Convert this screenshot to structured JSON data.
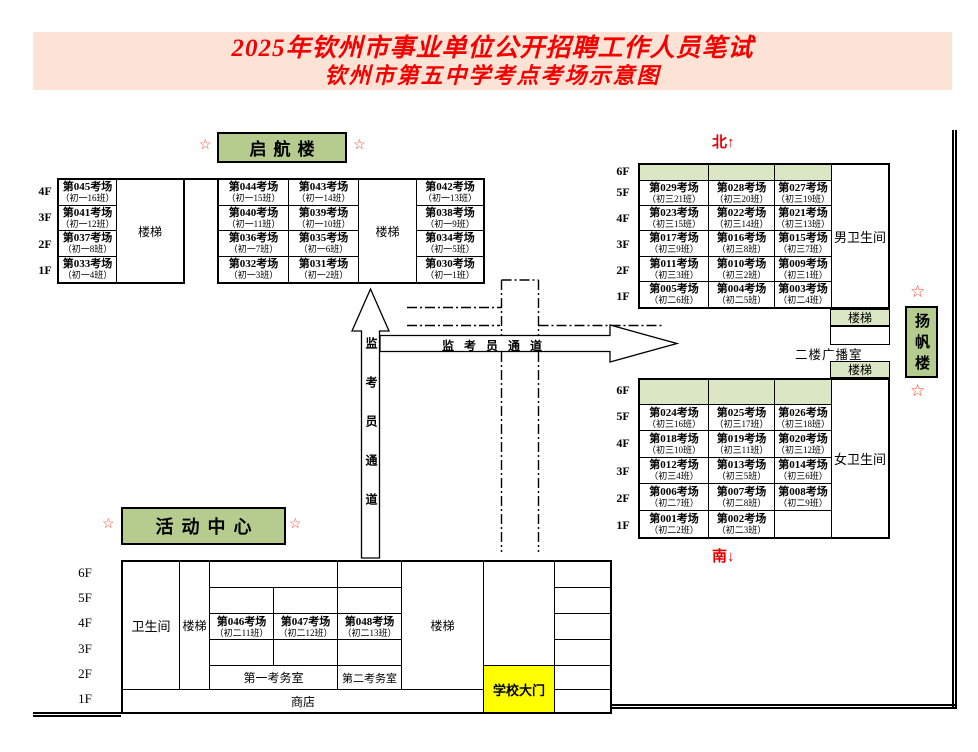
{
  "title": {
    "line1": "2025年钦州市事业单位公开招聘工作人员笔试",
    "line2": "钦州市第五中学考点考场示意图"
  },
  "compass": {
    "north": "北↑",
    "south": "南↓"
  },
  "decor": {
    "star": "☆"
  },
  "corridor": {
    "text": "监考员通道"
  },
  "misc": {
    "stairs": "楼梯",
    "toilet": "卫生间",
    "male_toilet": "男卫生间",
    "female_toilet": "女卫生间",
    "broadcast_room": "二楼广播室",
    "shop": "商店",
    "school_gate": "学校大门",
    "exam_office_1": "第一考务室",
    "exam_office_2": "第二考务室"
  },
  "floors": {
    "four": [
      "4F",
      "3F",
      "2F",
      "1F"
    ],
    "six": [
      "6F",
      "5F",
      "4F",
      "3F",
      "2F",
      "1F"
    ]
  },
  "buildings": {
    "qihang": {
      "name": "启航楼",
      "left_rooms": [
        {
          "n": "第045考场",
          "c": "（初一16班）"
        },
        {
          "n": "第041考场",
          "c": "（初一12班）"
        },
        {
          "n": "第037考场",
          "c": "（初一8班）"
        },
        {
          "n": "第033考场",
          "c": "（初一4班）"
        }
      ],
      "mid_rows": [
        [
          {
            "n": "第044考场",
            "c": "（初一15班）"
          },
          {
            "n": "第043考场",
            "c": "（初一14班）"
          },
          {
            "n": "第042考场",
            "c": "（初一13班）"
          }
        ],
        [
          {
            "n": "第040考场",
            "c": "（初一11班）"
          },
          {
            "n": "第039考场",
            "c": "（初一10班）"
          },
          {
            "n": "第038考场",
            "c": "（初一9班）"
          }
        ],
        [
          {
            "n": "第036考场",
            "c": "（初一7班）"
          },
          {
            "n": "第035考场",
            "c": "（初一6班）"
          },
          {
            "n": "第034考场",
            "c": "（初一5班）"
          }
        ],
        [
          {
            "n": "第032考场",
            "c": "（初一3班）"
          },
          {
            "n": "第031考场",
            "c": "（初一2班）"
          },
          {
            "n": "第030考场",
            "c": "（初一1班）"
          }
        ]
      ]
    },
    "yangfan": {
      "name": "扬帆楼",
      "north_rows": [
        [
          {
            "n": "第029考场",
            "c": "（初三21班）"
          },
          {
            "n": "第028考场",
            "c": "（初三20班）"
          },
          {
            "n": "第027考场",
            "c": "（初三19班）"
          }
        ],
        [
          {
            "n": "第023考场",
            "c": "（初三15班）"
          },
          {
            "n": "第022考场",
            "c": "（初三14班）"
          },
          {
            "n": "第021考场",
            "c": "（初三13班）"
          }
        ],
        [
          {
            "n": "第017考场",
            "c": "（初三9班）"
          },
          {
            "n": "第016考场",
            "c": "（初三8班）"
          },
          {
            "n": "第015考场",
            "c": "（初三7班）"
          }
        ],
        [
          {
            "n": "第011考场",
            "c": "（初三3班）"
          },
          {
            "n": "第010考场",
            "c": "（初三2班）"
          },
          {
            "n": "第009考场",
            "c": "（初三1班）"
          }
        ],
        [
          {
            "n": "第005考场",
            "c": "（初二6班）"
          },
          {
            "n": "第004考场",
            "c": "（初二5班）"
          },
          {
            "n": "第003考场",
            "c": "（初二4班）"
          }
        ]
      ],
      "south_rows": [
        [
          {
            "n": "第024考场",
            "c": "（初三16班）"
          },
          {
            "n": "第025考场",
            "c": "（初三17班）"
          },
          {
            "n": "第026考场",
            "c": "（初三18班）"
          }
        ],
        [
          {
            "n": "第018考场",
            "c": "（初三10班）"
          },
          {
            "n": "第019考场",
            "c": "（初三11班）"
          },
          {
            "n": "第020考场",
            "c": "（初三12班）"
          }
        ],
        [
          {
            "n": "第012考场",
            "c": "（初三4班）"
          },
          {
            "n": "第013考场",
            "c": "（初三5班）"
          },
          {
            "n": "第014考场",
            "c": "（初三6班）"
          }
        ],
        [
          {
            "n": "第006考场",
            "c": "（初二7班）"
          },
          {
            "n": "第007考场",
            "c": "（初二8班）"
          },
          {
            "n": "第008考场",
            "c": "（初二9班）"
          }
        ],
        [
          {
            "n": "第001考场",
            "c": "（初二2班）"
          },
          {
            "n": "第002考场",
            "c": "（初二3班）"
          }
        ]
      ]
    },
    "huodong": {
      "name": "活动中心",
      "rooms": [
        {
          "n": "第046考场",
          "c": "（初二11班）"
        },
        {
          "n": "第047考场",
          "c": "（初二12班）"
        },
        {
          "n": "第048考场",
          "c": "（初二13班）"
        }
      ]
    }
  }
}
